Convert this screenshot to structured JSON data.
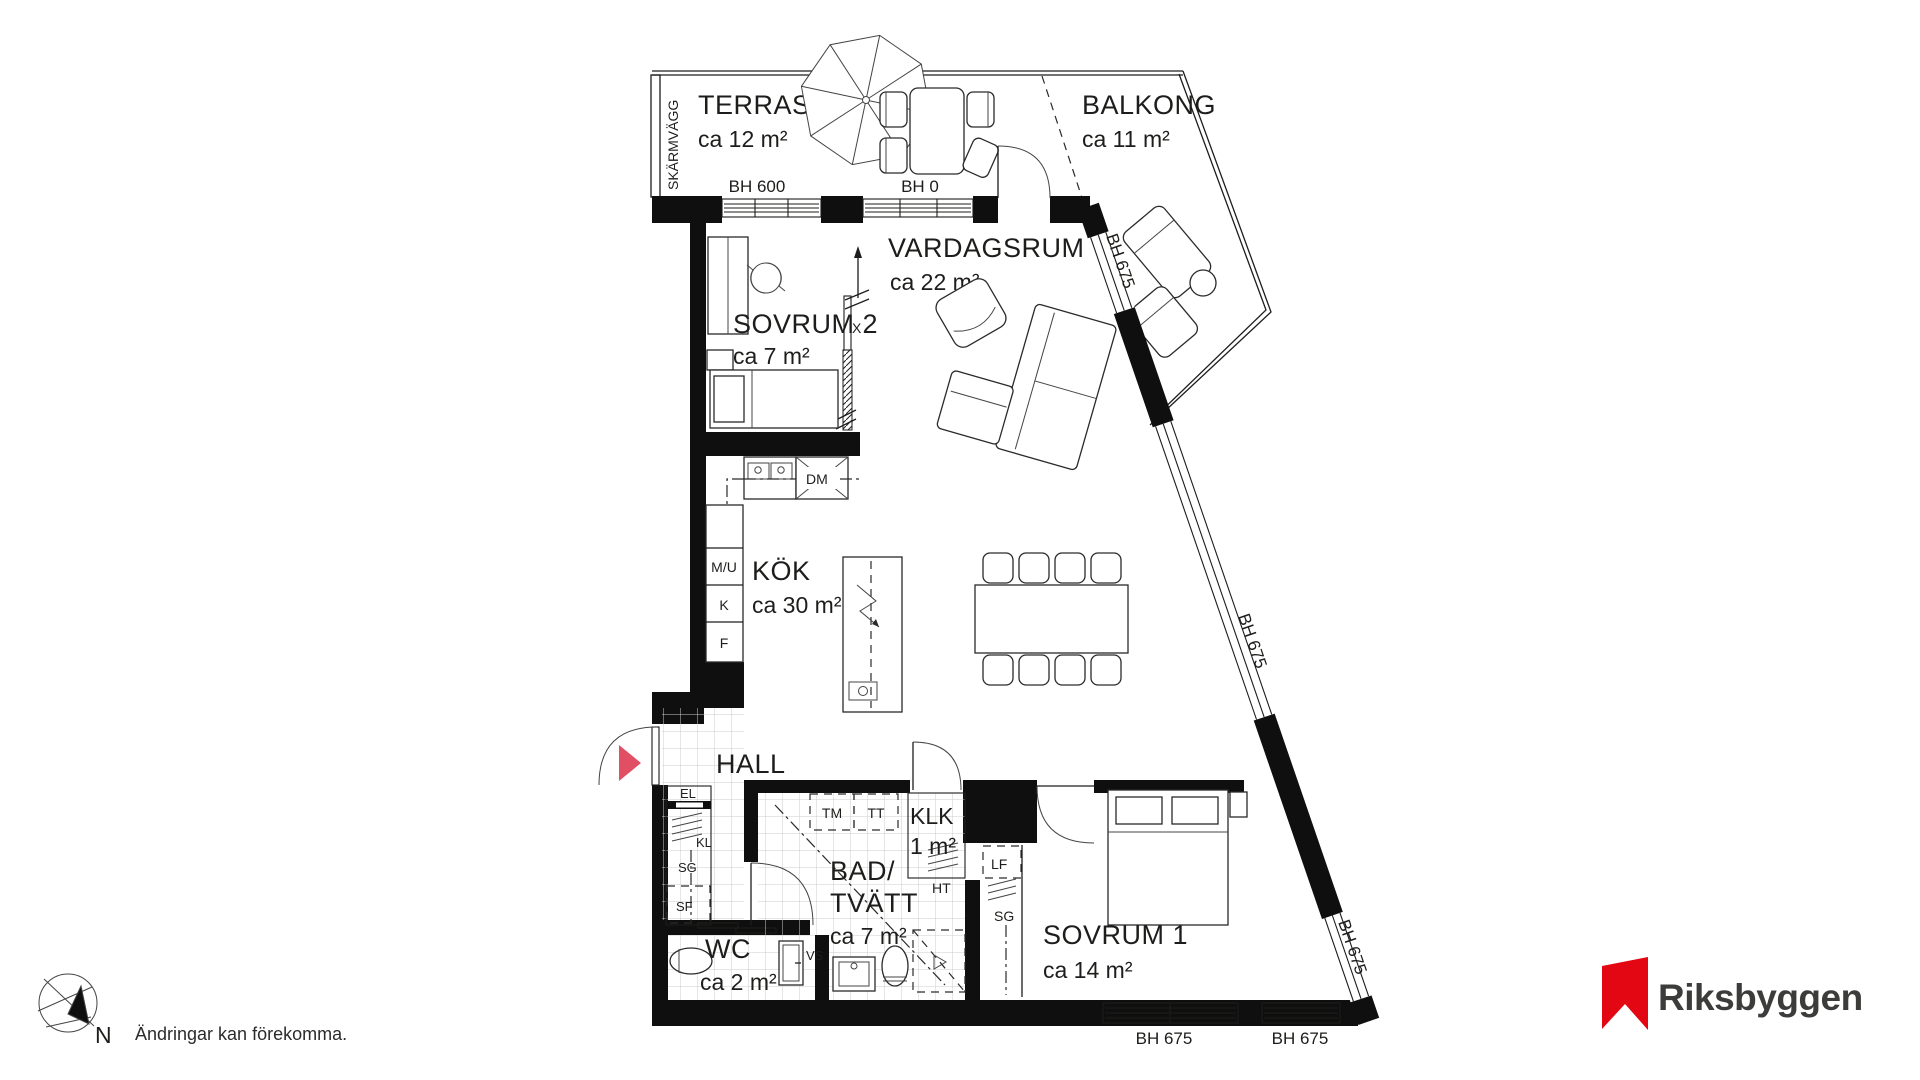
{
  "plan": {
    "rooms": {
      "terrass": {
        "name": "TERRASS",
        "area": "ca 12 m²"
      },
      "balkong": {
        "name": "BALKONG",
        "area": "ca 11 m²"
      },
      "vardagsrum": {
        "name": "VARDAGSRUM",
        "area": "ca 22 m²"
      },
      "sovrum2": {
        "name": "SOVRUM 2",
        "area": "ca 7 m²"
      },
      "kok": {
        "name": "KÖK",
        "area": "ca 30 m²"
      },
      "hall": {
        "name": "HALL"
      },
      "klk": {
        "name": "KLK",
        "area": "1 m²"
      },
      "bad_tvatt": {
        "name_line1": "BAD/",
        "name_line2": "TVÄTT",
        "area": "ca 7 m²"
      },
      "wc": {
        "name": "WC",
        "area": "ca 2 m²"
      },
      "sovrum1": {
        "name": "SOVRUM 1",
        "area": "ca 14 m²"
      }
    },
    "window_head_labels": {
      "terrace_window": "BH 600",
      "terrace_door": "BH 0",
      "diagonal_upper": "BH 675",
      "diagonal_middle": "BH 675",
      "diagonal_lower": "BH 675",
      "bottom_left": "BH 675",
      "bottom_right": "BH 675"
    },
    "fixture_labels": {
      "dm": "DM",
      "mu": "M/U",
      "k": "K",
      "f": "F",
      "el": "EL",
      "kl": "KL",
      "sg_hall": "SG",
      "sf": "SF",
      "tm": "TM",
      "tt": "TT",
      "ht": "HT",
      "lf": "LF",
      "sg_sovrum1": "SG",
      "vs": "VS",
      "section_marker": "X"
    },
    "annotations": {
      "screen_wall": "SKÄRMVÄGG",
      "compass_north": "N",
      "disclaimer": "Ändringar kan förekomma."
    },
    "colors": {
      "entrance_marker": "#e04f63",
      "brand_red": "#e30613",
      "line": "#1d1d1b"
    }
  },
  "brand": {
    "wordmark": "Riksbyggen"
  }
}
